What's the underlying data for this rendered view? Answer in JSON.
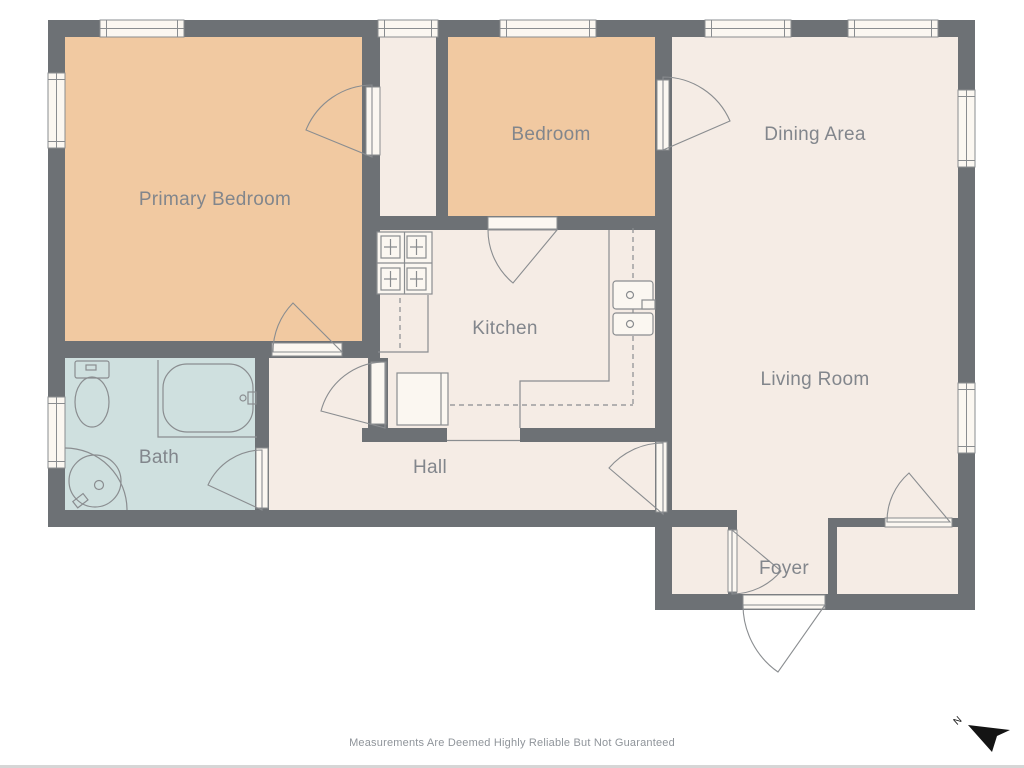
{
  "title": "Apartment Floor Plan",
  "rooms": [
    {
      "id": "primary-bedroom",
      "label": "Primary Bedroom"
    },
    {
      "id": "bedroom",
      "label": "Bedroom"
    },
    {
      "id": "dining-area",
      "label": "Dining Area"
    },
    {
      "id": "kitchen",
      "label": "Kitchen"
    },
    {
      "id": "living-room",
      "label": "Living Room"
    },
    {
      "id": "bath",
      "label": "Bath"
    },
    {
      "id": "hall",
      "label": "Hall"
    },
    {
      "id": "foyer",
      "label": "Foyer"
    }
  ],
  "fixtures": [
    "stove",
    "refrigerator",
    "double-sink",
    "counter",
    "toilet",
    "bathtub",
    "vanity-sink"
  ],
  "footer": {
    "disclaimer": "Measurements Are Deemed Highly Reliable But Not Guaranteed"
  },
  "compass": {
    "label": "N"
  },
  "colors": {
    "wall": "#6d7175",
    "floor": "#f5ece5",
    "bedroom_floor": "#f1c9a1",
    "bath_floor": "#cfe0df",
    "window_fill": "#fbf7f1",
    "thin_line": "#8a8d90",
    "label_text": "#82868c",
    "disclaimer_text": "#8f949a",
    "north": "#141414",
    "page_edge": "#d6d6d6"
  }
}
